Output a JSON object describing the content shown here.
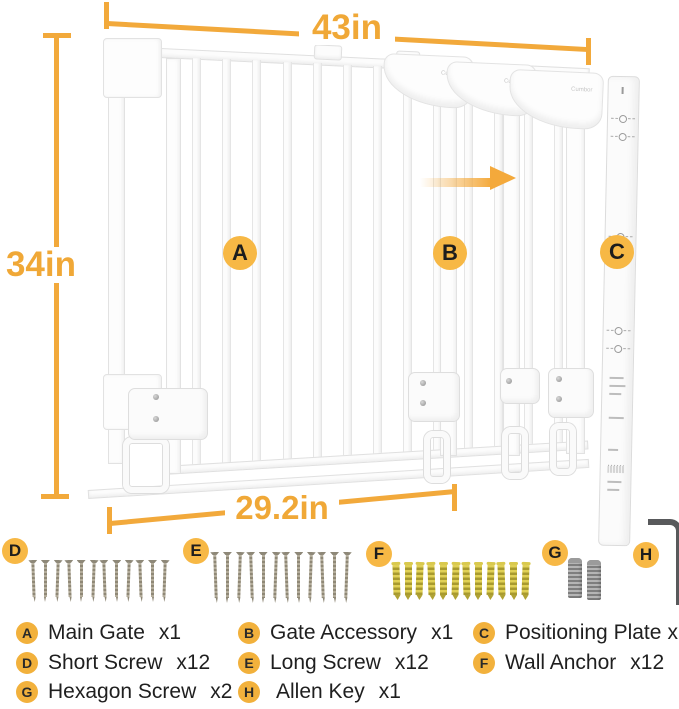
{
  "colors": {
    "accent": "#F2A93B",
    "badge": "#F7B845"
  },
  "dimensions": {
    "top": "43in",
    "left": "34in",
    "bottom": "29.2in"
  },
  "gate": {
    "panel_logo": "Cumbor",
    "bars_count": 13,
    "panel_count": 3
  },
  "hardware": {
    "short_screw_count": 12,
    "long_screw_count": 12,
    "wall_anchor_count": 12,
    "hexagon_screw_count": 2,
    "allen_key_count": 1
  },
  "legend": {
    "items": [
      {
        "key": "A",
        "name": "Main Gate",
        "qty": "x1"
      },
      {
        "key": "B",
        "name": "Gate Accessory",
        "qty": "x1"
      },
      {
        "key": "C",
        "name": "Positioning Plate",
        "qty": "x2"
      },
      {
        "key": "D",
        "name": "Short Screw",
        "qty": "x12"
      },
      {
        "key": "E",
        "name": "Long Screw",
        "qty": "x12"
      },
      {
        "key": "F",
        "name": "Wall Anchor",
        "qty": "x12"
      },
      {
        "key": "G",
        "name": "Hexagon Screw",
        "qty": "x2"
      },
      {
        "key": "H",
        "name": "Allen Key",
        "qty": "x1"
      }
    ]
  }
}
